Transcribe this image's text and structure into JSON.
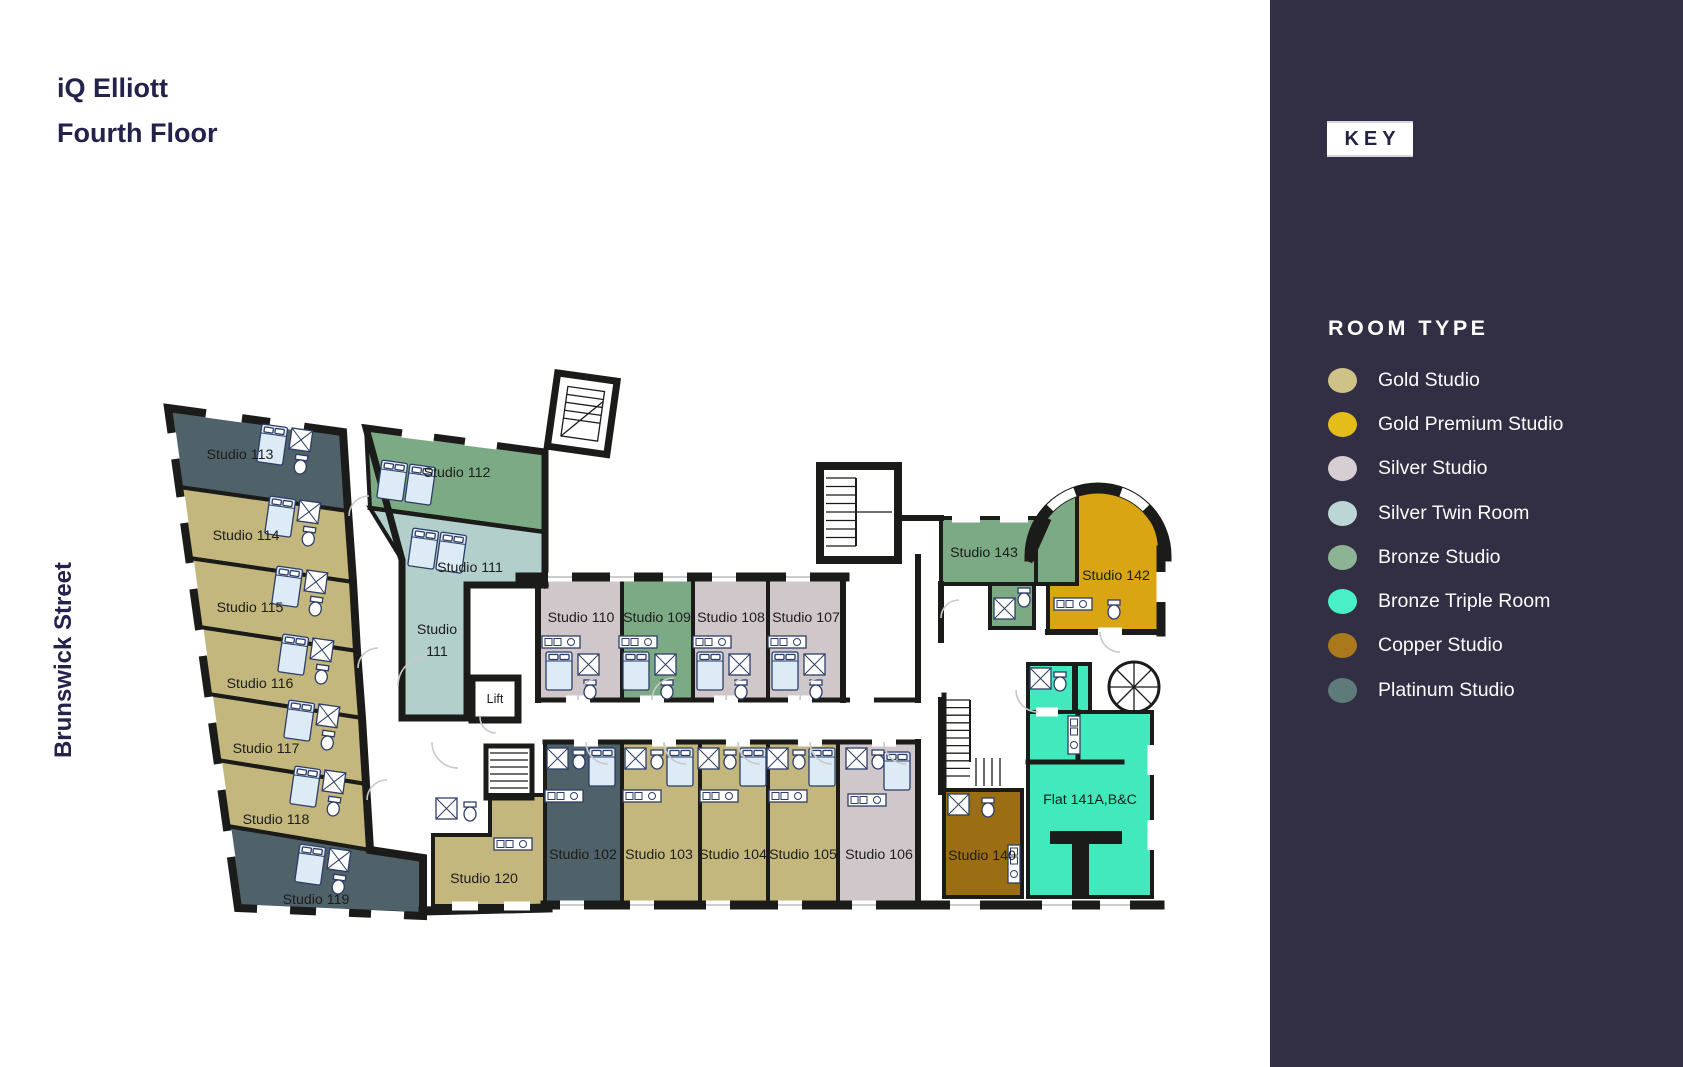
{
  "title": {
    "line1": "iQ Elliott",
    "line2": "Fourth Floor"
  },
  "street_label": "Brunswick Street",
  "key": {
    "heading": "KEY",
    "section_title": "ROOM TYPE",
    "legend": [
      {
        "label": "Gold Studio",
        "color": "#cec289"
      },
      {
        "label": "Gold Premium Studio",
        "color": "#e5bd1b"
      },
      {
        "label": "Silver Studio",
        "color": "#d7ced4"
      },
      {
        "label": "Silver Twin Room",
        "color": "#bcd6d5"
      },
      {
        "label": "Bronze Studio",
        "color": "#8cb394"
      },
      {
        "label": "Bronze Triple Room",
        "color": "#4af0c5"
      },
      {
        "label": "Copper Studio",
        "color": "#a9791b"
      },
      {
        "label": "Platinum Studio",
        "color": "#5e7a79"
      }
    ]
  },
  "floorplan": {
    "rooms": [
      {
        "id": "studio-102",
        "label": "Studio 102",
        "type": "Platinum Studio"
      },
      {
        "id": "studio-103",
        "label": "Studio 103",
        "type": "Gold Studio"
      },
      {
        "id": "studio-104",
        "label": "Studio 104",
        "type": "Gold Studio"
      },
      {
        "id": "studio-105",
        "label": "Studio 105",
        "type": "Gold Studio"
      },
      {
        "id": "studio-106",
        "label": "Studio 106",
        "type": "Silver Studio"
      },
      {
        "id": "studio-107",
        "label": "Studio 107",
        "type": "Silver Studio"
      },
      {
        "id": "studio-108",
        "label": "Studio 108",
        "type": "Silver Studio"
      },
      {
        "id": "studio-109",
        "label": "Studio 109",
        "type": "Bronze Studio"
      },
      {
        "id": "studio-110",
        "label": "Studio 110",
        "type": "Silver Studio"
      },
      {
        "id": "studio-111",
        "label": "Studio 111",
        "label_line1": "Studio",
        "label_line2": "111",
        "type": "Silver Twin Room"
      },
      {
        "id": "studio-112",
        "label": "Studio 112",
        "type": "Bronze Studio"
      },
      {
        "id": "studio-113",
        "label": "Studio 113",
        "type": "Platinum Studio"
      },
      {
        "id": "studio-114",
        "label": "Studio 114",
        "type": "Gold Studio"
      },
      {
        "id": "studio-115",
        "label": "Studio 115",
        "type": "Gold Studio"
      },
      {
        "id": "studio-116",
        "label": "Studio 116",
        "type": "Gold Studio"
      },
      {
        "id": "studio-117",
        "label": "Studio 117",
        "type": "Gold Studio"
      },
      {
        "id": "studio-118",
        "label": "Studio 118",
        "type": "Gold Studio"
      },
      {
        "id": "studio-119",
        "label": "Studio 119",
        "type": "Platinum Studio"
      },
      {
        "id": "studio-120",
        "label": "Studio 120",
        "type": "Gold Studio"
      },
      {
        "id": "studio-140",
        "label": "Studio 140",
        "type": "Copper Studio"
      },
      {
        "id": "studio-142",
        "label": "Studio 142",
        "type": "Gold Premium Studio"
      },
      {
        "id": "studio-143",
        "label": "Studio 143",
        "type": "Bronze Studio"
      },
      {
        "id": "flat-141",
        "label": "Flat 141A,B&C",
        "type": "Bronze Triple Room"
      },
      {
        "id": "lift",
        "label": "Lift",
        "type": "Lift"
      }
    ]
  },
  "colors": {
    "sidebar_bg": "#322e43",
    "wall": "#1b1b19",
    "title_text": "#23224a",
    "label_text": "#1d1d1b",
    "door_arc": "#c9c9c9",
    "furniture_fill": "#dcebf5",
    "furniture_stroke": "#2e3d66",
    "room_fill": {
      "gold": "#c4b77d",
      "gold_premium": "#d9a513",
      "silver": "#d0c7cb",
      "silver_twin": "#b2cfcc",
      "bronze": "#7caa85",
      "bronze_triple": "#41e9bd",
      "copper": "#9c6e13",
      "platinum": "#4f6169"
    }
  }
}
